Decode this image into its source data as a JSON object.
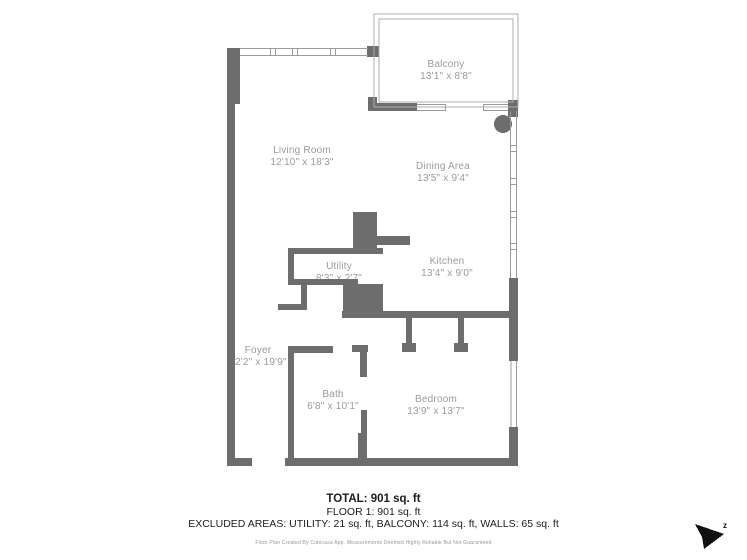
{
  "colors": {
    "wall": "#6d6d6d",
    "window_line": "#9b9b9b",
    "balcony_line": "#aeaeae",
    "room_label": "#9a9a9a",
    "summary_text": "#1c1c1c",
    "disclaimer_text": "#969696",
    "cursor": "#111111"
  },
  "rooms": [
    {
      "name": "Balcony",
      "dims": "13'1\" x 8'8\""
    },
    {
      "name": "Living Room",
      "dims": "12'10\" x 18'3\""
    },
    {
      "name": "Dining Area",
      "dims": "13'5\" x 9'4\""
    },
    {
      "name": "Utility",
      "dims": "8'3\" x 2'7\""
    },
    {
      "name": "Kitchen",
      "dims": "13'4\" x 9'0\""
    },
    {
      "name": "Foyer",
      "dims": "12'2\" x 19'9\""
    },
    {
      "name": "Bath",
      "dims": "6'8\" x 10'1\""
    },
    {
      "name": "Bedroom",
      "dims": "13'9\" x 13'7\""
    }
  ],
  "summary": {
    "total": "TOTAL: 901 sq. ft",
    "floor": "FLOOR 1: 901 sq. ft",
    "excluded": "EXCLUDED AREAS: UTILITY: 21 sq. ft, BALCONY: 114 sq. ft, WALLS: 65 sq. ft"
  },
  "footer": {
    "disclaimer": "Floor Plan Created By Cubicasa App. Measurements Deemed Highly Reliable But Not Guaranteed"
  },
  "cursor": {
    "badge": "z"
  }
}
